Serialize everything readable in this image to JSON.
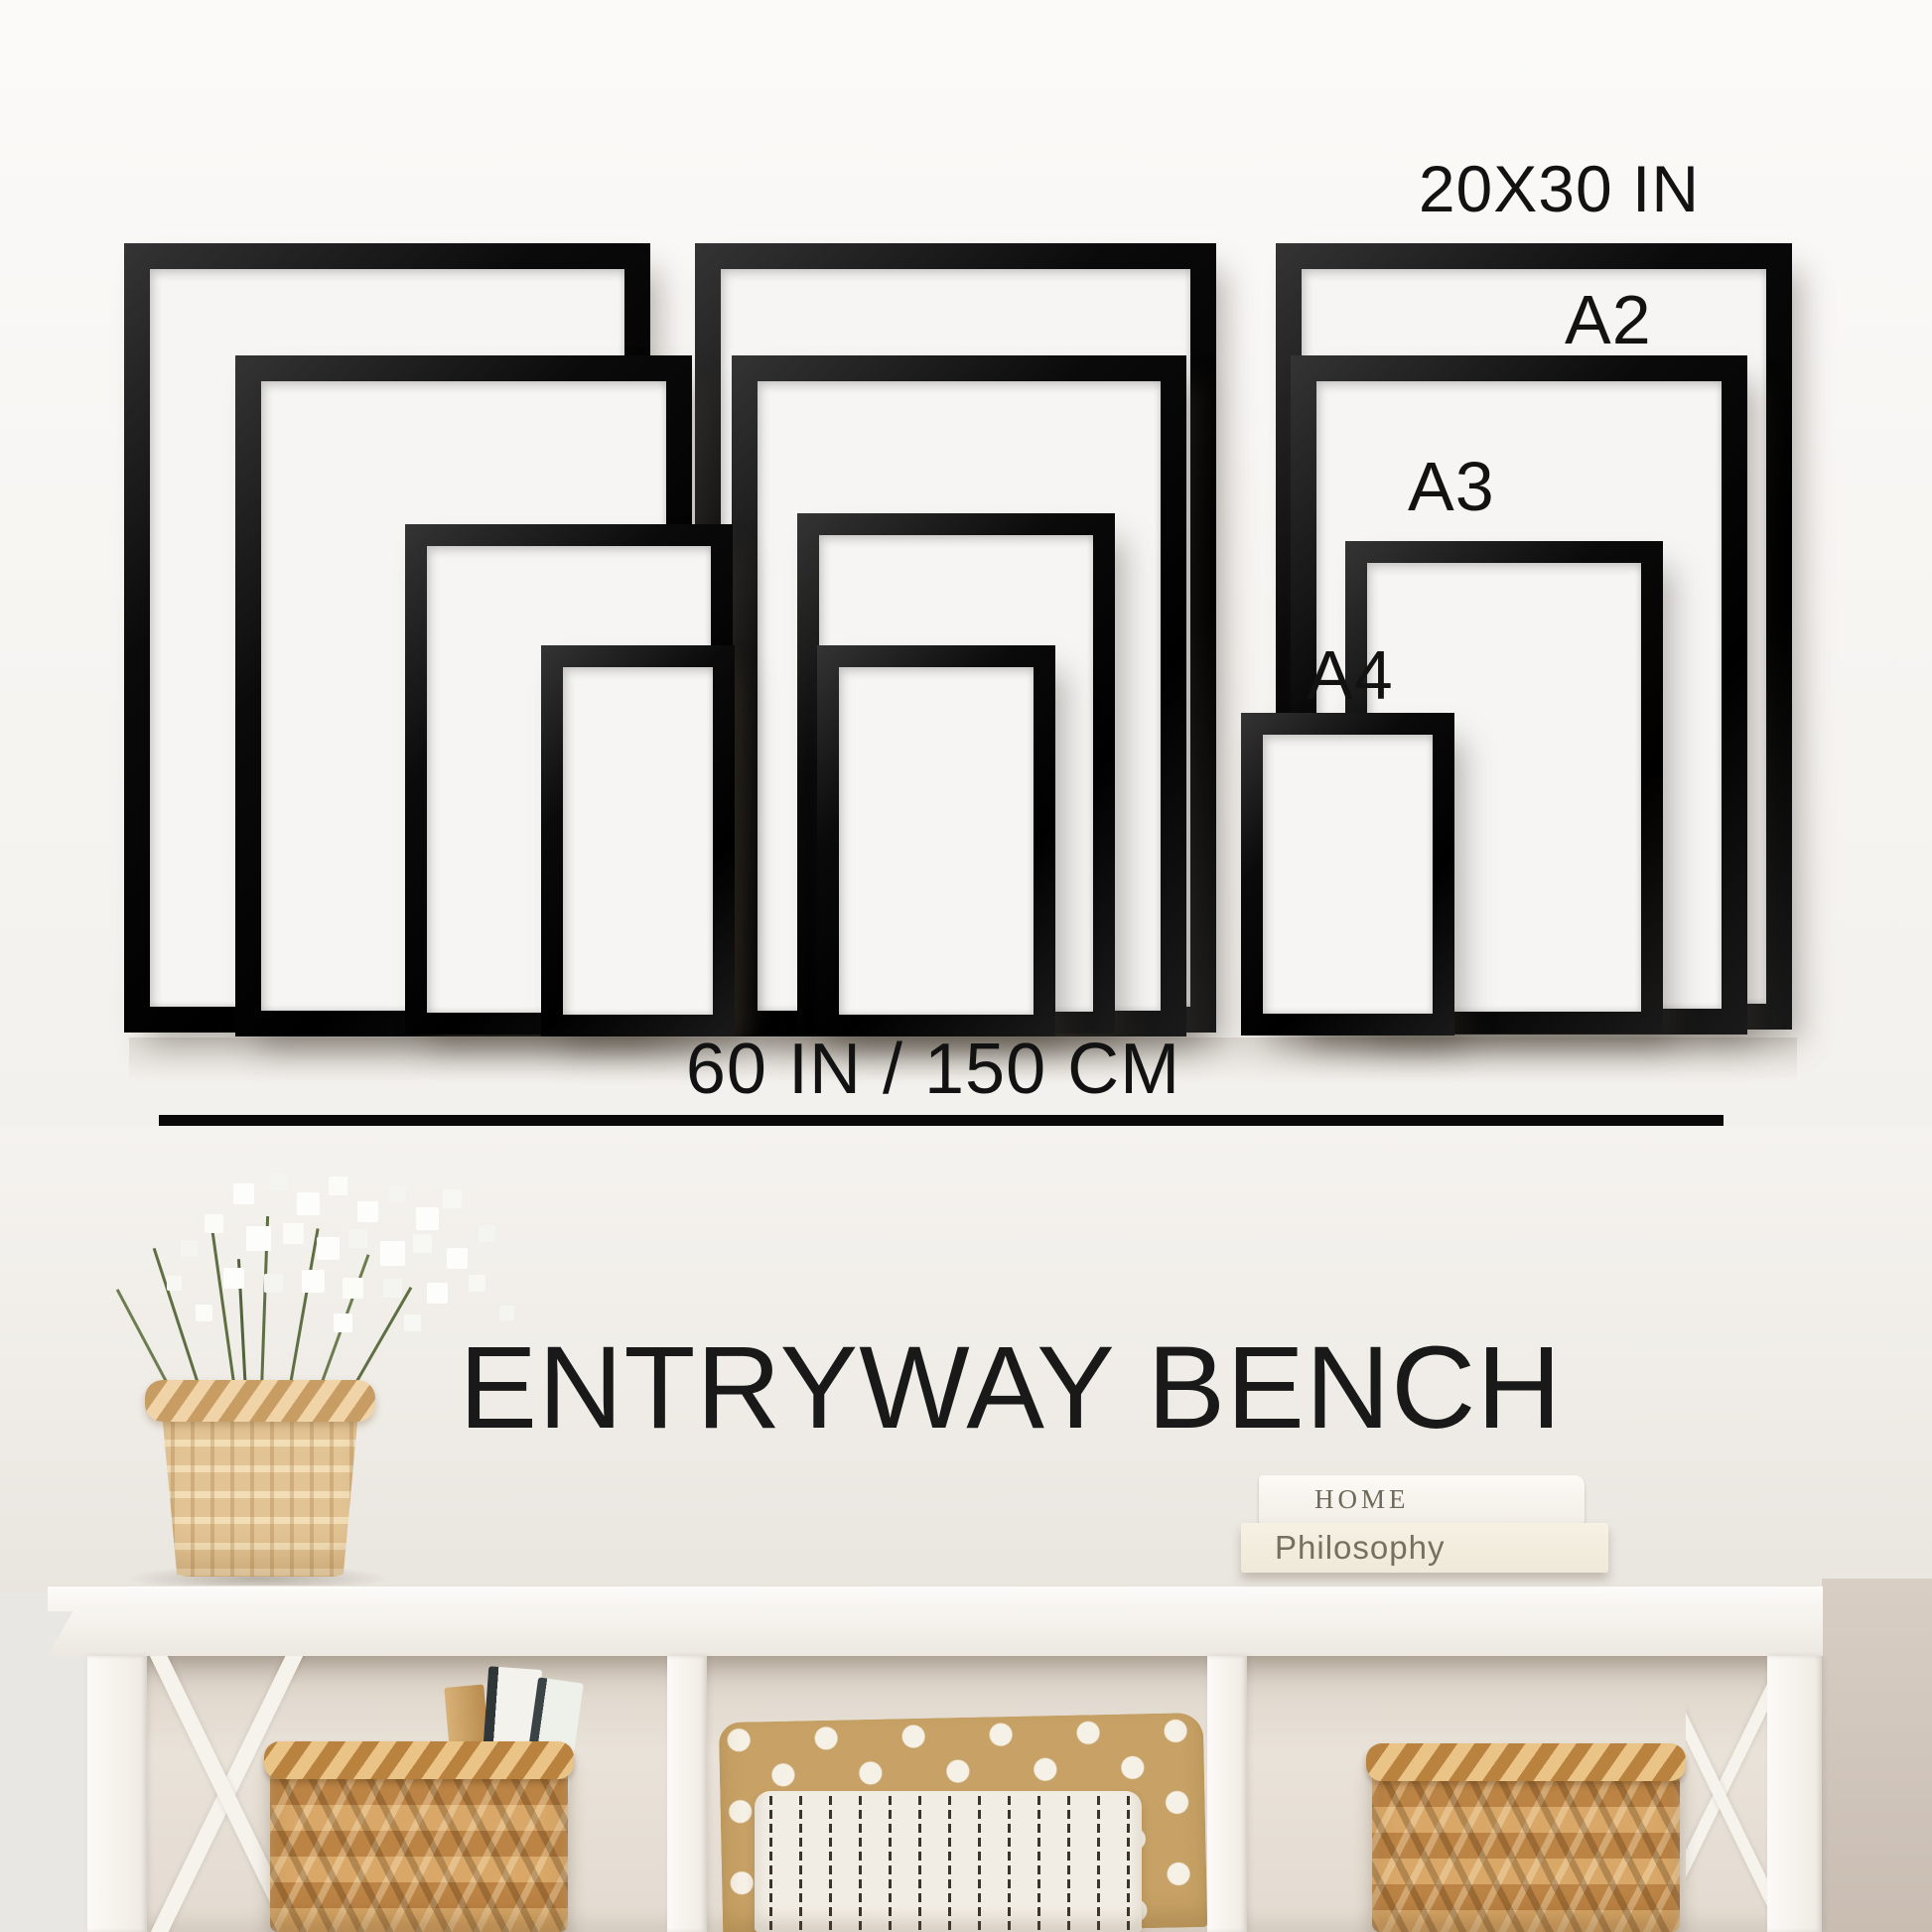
{
  "size_guide": {
    "label_largest": "20X30 IN",
    "label_a2": "A2",
    "label_a3": "A3",
    "label_a4": "A4",
    "width_caption": "60 IN / 150 CM",
    "frame_sizes": [
      "20X30 IN",
      "A2",
      "A3",
      "A4"
    ]
  },
  "caption": {
    "title": "ENTRYWAY BENCH"
  },
  "decor": {
    "book_top_title": "HOME",
    "book_bottom_title": "Philosophy"
  },
  "colors": {
    "frame_black": "#0d0d0d",
    "text_black": "#141414",
    "wall_white": "#f6f4f1",
    "wall_greige": "#cfc4ba",
    "bench_white": "#f7f4f0",
    "basket_tan": "#d9a868",
    "pillow_polka_tan": "#c7a165",
    "pillow_stripe_cream": "#f2ede4"
  }
}
